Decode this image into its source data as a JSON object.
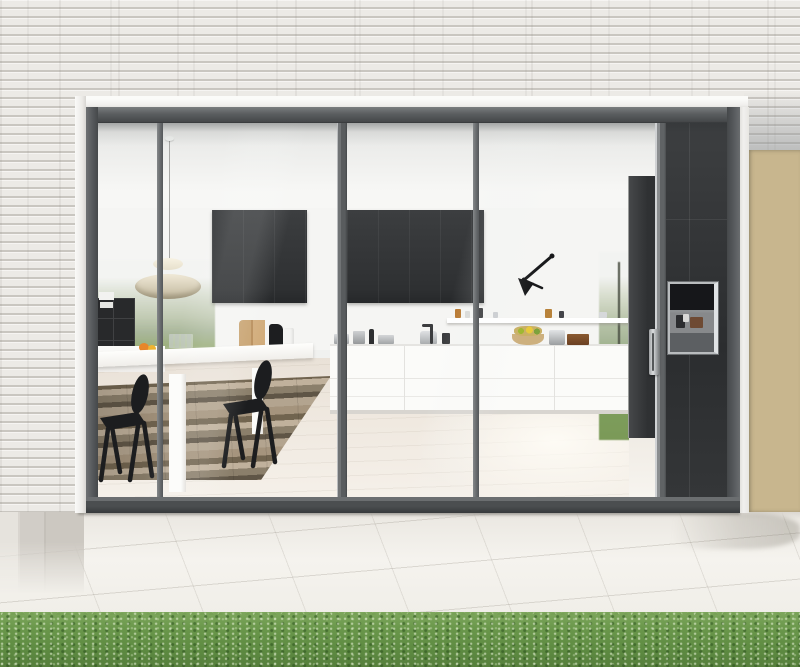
{
  "image": {
    "type": "photograph",
    "subject": "Modern kitchen seen from a paved patio through a full-height glazed sliding wall set in a white brick facade, with timber slat cladding at the right and a lawn in the foreground",
    "visible_text": "none"
  },
  "labels": {
    "photo": "Photograph of a modern kitchen behind a glazed sliding wall, viewed from the patio",
    "brick_facade": "White brick facade",
    "lintel": "White lintel above the glazed wall",
    "frame": "Grey aluminium frame",
    "glass_wall": "Full-height glazed sliding wall",
    "mullion": "Slim vertical mullion",
    "door_stile": "Sliding door stile",
    "door_handle": "Vertical stainless door pull",
    "ceiling": "White interior ceiling",
    "pendant_lamp": "Layered cream pendant lamp",
    "wall_lamp": "Black articulated wall lamp",
    "upper_cabinets": "Charcoal wall cabinets",
    "open_shelf": "Floating shelf with jars and chopping boards",
    "base_cabinets": "Handleless white base cabinets",
    "worktop_items": "Pots and kitchenware on the worktop",
    "fruit_basket": "Wire basket with fruit",
    "shelving_unit": "Black open shelving unit",
    "sideboard": "White sideboard with fruit and glasses",
    "dining_table": "White dining table",
    "chair": "Black wooden chair",
    "rug": "Patchwork rug in brown and grey tones",
    "wood_floor": "Pale timber floor",
    "garden_view_left": "Garden view through rear glazing, left",
    "garden_view_right": "Garden view through rear glazing, right",
    "tall_units": "Charcoal tall units",
    "coffee_machine": "Built-in stainless appliance niche",
    "timber_slats": "Horizontal timber slat cladding",
    "patio": "Pale stone patio paving",
    "steps": "Stone steps at the left edge",
    "lawn": "Green lawn strip in the foreground"
  },
  "palette": {
    "brick": "#ebe9e5",
    "mortar": "#d7d4cf",
    "frame_grey": "#54575a",
    "trim_white": "#f2f1ef",
    "cabinet_charcoal": "#333538",
    "cabinet_white": "#fbfbf9",
    "wood_floor": "#ece4da",
    "rug_brown": "#8b7f6b",
    "patio_stone": "#f0eee9",
    "grass_green": "#6c984e",
    "slat_timber": "#c8b68e",
    "steel": "#c3c5c7"
  }
}
